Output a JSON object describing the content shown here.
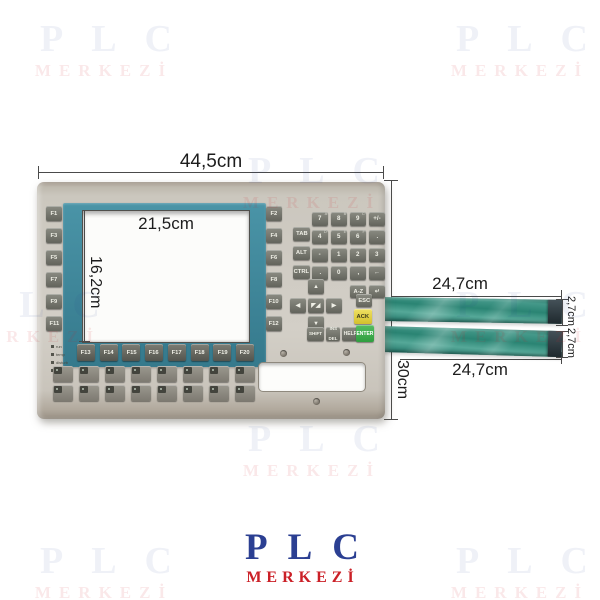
{
  "watermark": {
    "line1": "PLC",
    "line2": "MERKEZİ"
  },
  "logo": {
    "line1": "PLC",
    "line2": "MERKEZİ"
  },
  "dimensions": {
    "overall_width": "44,5cm",
    "overall_height": "30cm",
    "display_width": "21,5cm",
    "display_height": "16,2cm",
    "top_cable_length": "24,7cm",
    "top_cable_width": "2,7cm",
    "bottom_cable_length": "24,7cm",
    "bottom_cable_width": "2,7cm"
  },
  "keypad": {
    "left_function_keys": [
      "F1",
      "F3",
      "F5",
      "F7",
      "F9",
      "F11"
    ],
    "right_function_keys": [
      "F2",
      "F4",
      "F6",
      "F8",
      "F10",
      "F12"
    ],
    "bottom_function_keys": [
      "F13",
      "F14",
      "F15",
      "F16",
      "F17",
      "F18",
      "F19",
      "F20"
    ],
    "modifier_keys": [
      "TAB",
      "ALT",
      "CTRL"
    ],
    "numpad_keys": [
      {
        "m": "7",
        "c": "A"
      },
      {
        "m": "8",
        "c": "B"
      },
      {
        "m": "9",
        "c": "C"
      },
      {
        "m": "+/-"
      },
      {
        "m": "4",
        "c": "D"
      },
      {
        "m": "5",
        "c": "E"
      },
      {
        "m": "6",
        "c": "F"
      },
      {
        "m": "."
      },
      {
        "m": "-"
      },
      {
        "m": "1"
      },
      {
        "m": "2"
      },
      {
        "m": "3"
      },
      {
        "m": "."
      },
      {
        "m": "0"
      },
      {
        "m": ","
      },
      {
        "m": "←"
      }
    ],
    "az_key": "A-Z",
    "enter_arrow_key": "↵",
    "nav_keys": {
      "up": "▲",
      "left": "◀",
      "center": "◤◢",
      "right": "▶",
      "down": "▼"
    },
    "esc_key": "ESC",
    "ack_key": "ACK",
    "shift_key": "SHIFT",
    "ins_key": "INS",
    "del_key": "DEL",
    "help_key": "HELP",
    "enter_key": "ENTER",
    "led_legend": [
      "run",
      "temp",
      "disturb",
      "power"
    ],
    "soft_keys_row1": [
      "",
      "",
      "",
      "",
      "",
      "",
      "",
      ""
    ],
    "soft_keys_row2": [
      "",
      "",
      "",
      "",
      "",
      "",
      "",
      ""
    ]
  },
  "colors": {
    "bezel_teal": "#3f8699",
    "cable_teal": "#2e8a7b",
    "ack_yellow": "#ddca34",
    "enter_green": "#3fae4c",
    "panel_beige": "#cfcbc2",
    "logo_blue": "#2b3f92",
    "logo_red": "#cb2027"
  }
}
